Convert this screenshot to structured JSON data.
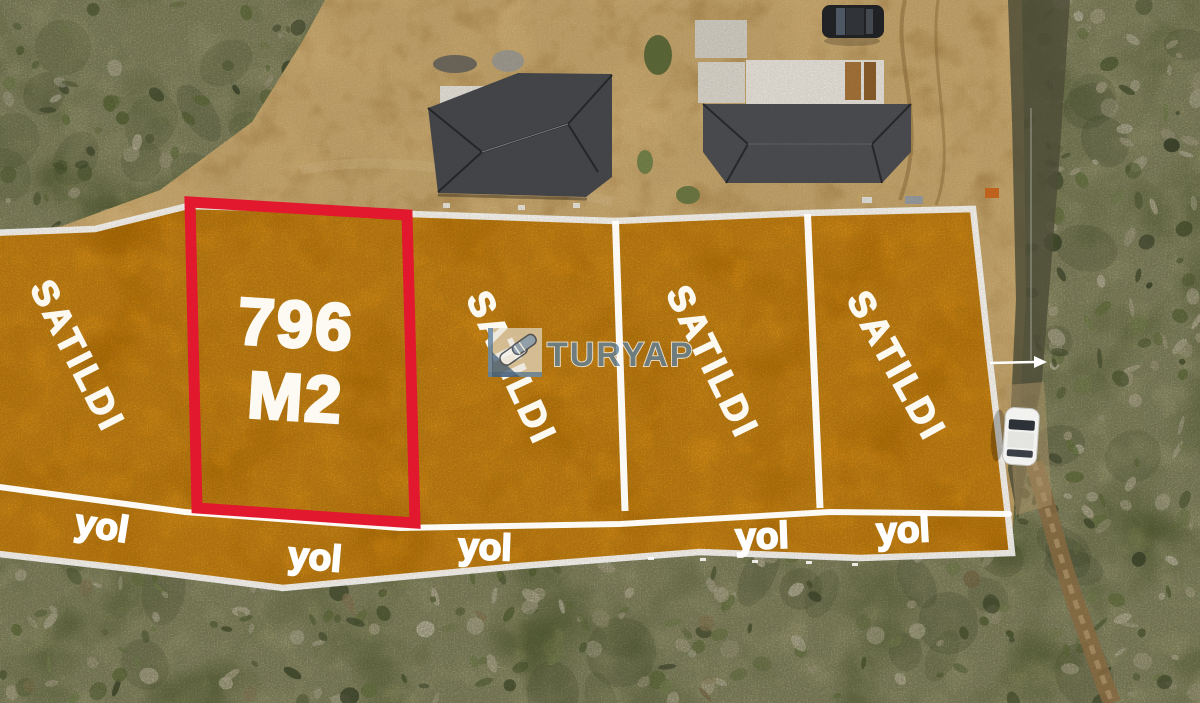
{
  "photo": {
    "description": "aerial drone photo of land parcels with sale overlay",
    "watermark": {
      "brand": "TURYAP",
      "logo": "handshake-icon"
    },
    "highlight_plot": {
      "area_line1": "796",
      "area_line2": "M2",
      "border_color": "#e2182e"
    },
    "plots": [
      {
        "label": "SATILDI"
      },
      {
        "label": "SATILDI"
      },
      {
        "label": "SATILDI"
      },
      {
        "label": "SATILDI"
      }
    ],
    "road_labels": [
      "yol",
      "yol",
      "yol",
      "yol",
      "yol"
    ],
    "colors": {
      "overlay_orange": "#de8c0c",
      "highlight_red": "#e2182e",
      "boundary_white": "#ffffff",
      "brand_blue": "#5e7f9b"
    }
  }
}
